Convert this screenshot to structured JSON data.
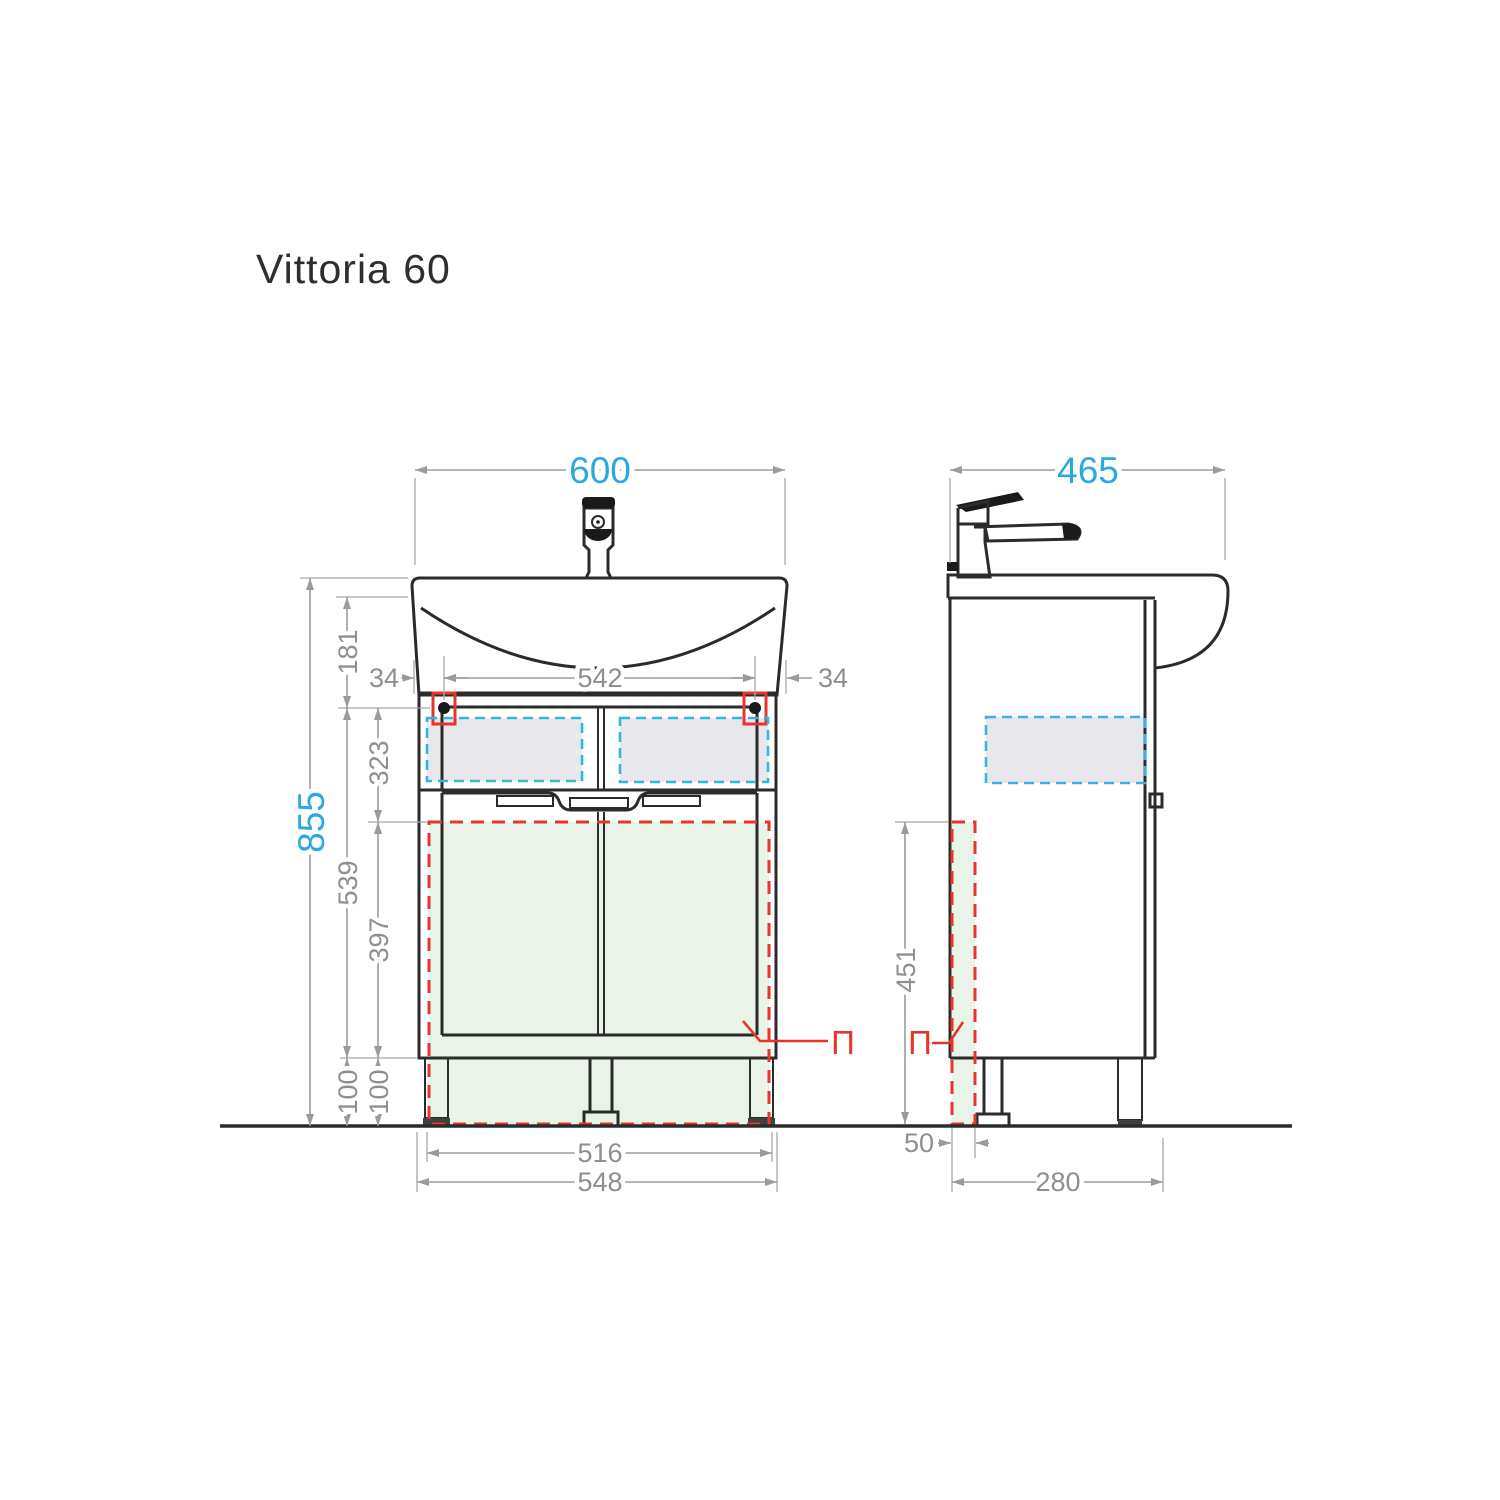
{
  "title": "Vittoria 60",
  "colors": {
    "line_dark": "#2b2b2b",
    "dimension_gray": "#9b9b9b",
    "accent_blue": "#2aa9e0",
    "section_red": "#e6362c",
    "overlay_cyan": "#36b3e6",
    "overlay_green": "#eaf3e8",
    "overlay_gray": "#e8e8ea"
  },
  "dims": {
    "front": {
      "width": "600",
      "height": "855",
      "offset_left": "34",
      "hinge_span": "542",
      "offset_right": "34",
      "top_to_hinge": "181",
      "hinge_to_panel": "323",
      "hinge_to_base": "539",
      "panel_height": "397",
      "leg_height_1": "100",
      "leg_height_2": "100",
      "feet_inner": "516",
      "feet_outer": "548"
    },
    "side": {
      "depth": "465",
      "panel_height": "451",
      "panel_depth": "50",
      "leg_offset": "280"
    }
  },
  "labels": {
    "front_section": "П",
    "side_section": "П"
  }
}
